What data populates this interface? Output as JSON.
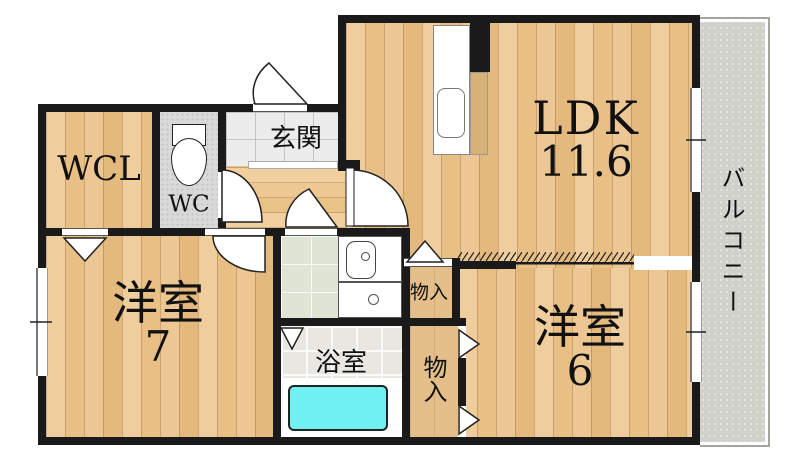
{
  "floorplan": {
    "rooms": {
      "ldk": {
        "label": "LDK",
        "size": "11.6"
      },
      "bedroom7": {
        "label": "洋室",
        "size": "7"
      },
      "bedroom6": {
        "label": "洋室",
        "size": "6"
      },
      "wcl": {
        "label": "WCL"
      },
      "wc": {
        "label": "WC"
      },
      "entrance": {
        "label": "玄関"
      },
      "bathroom": {
        "label": "浴室"
      },
      "storage_upper": {
        "label": "物入"
      },
      "storage_lower": {
        "label": "物入"
      },
      "balcony": {
        "label": "バルコニー"
      }
    },
    "icons": {
      "toilet": "toilet-icon",
      "kitchen_sink": "kitchen-sink-icon",
      "vanity_sink": "vanity-sink-icon",
      "washing_machine_pan": "washing-machine-pan-icon",
      "bathtub": "bathtub-icon"
    },
    "colors": {
      "wall": "#1a1a1a",
      "wood_floor": "#e9c28b",
      "entrance_tile": "#ececec",
      "wc_tile": "#d9d9d9",
      "washroom_tile": "#dfe5d5",
      "bathroom_tile": "#e9e7e1",
      "bathtub": "#70f1f1",
      "balcony": "#d1d1cb"
    }
  }
}
